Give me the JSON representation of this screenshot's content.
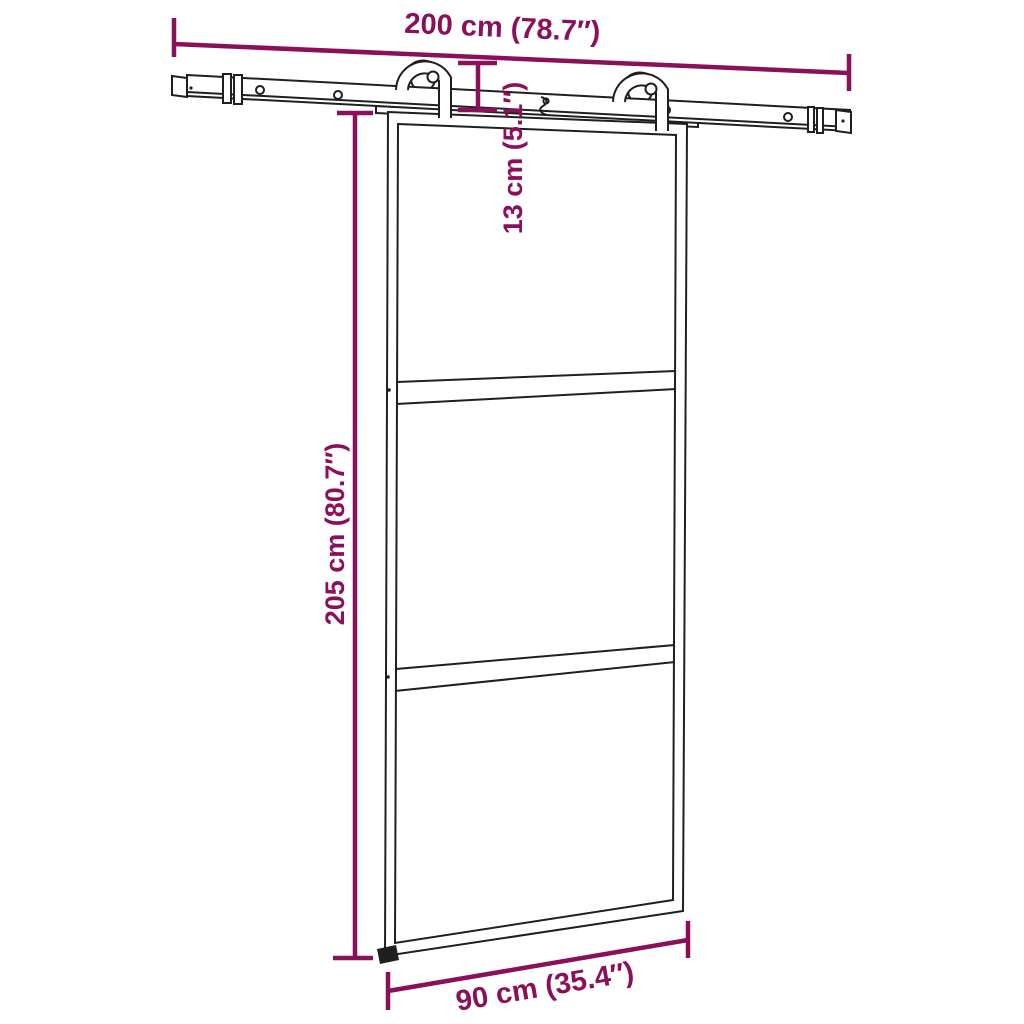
{
  "diagram": {
    "description": "Dimension drawing of a sliding barn door (3 glass panels) hanging from a top rail with two roller hangers",
    "colors": {
      "dimension_annotation": "#8C0F5A",
      "line_art": "#1F1F1F",
      "background": "#FFFFFF"
    },
    "dimensions": {
      "rail_length": {
        "label": "200 cm (78.7″)",
        "cm": 200,
        "inches": 78.7
      },
      "hanger_drop": {
        "label": "13 cm (5.1″)",
        "cm": 13,
        "inches": 5.1
      },
      "door_height": {
        "label": "205 cm (80.7″)",
        "cm": 205,
        "inches": 80.7
      },
      "door_width": {
        "label": "90 cm (35.4″)",
        "cm": 90,
        "inches": 35.4
      }
    },
    "parts": {
      "glass_panel_count": 3,
      "roller_count": 2
    }
  }
}
